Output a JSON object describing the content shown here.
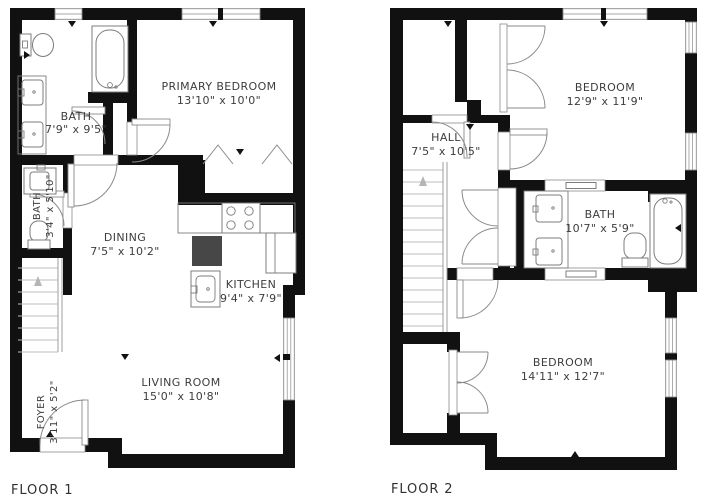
{
  "colors": {
    "wall": "#111111",
    "line": "#8a8a8a",
    "fixture": "#7c7c7c",
    "text": "#3d3d3d",
    "island": "#474747",
    "tread": "#bcbcbc",
    "arrow": "#b5b5b5"
  },
  "floors": [
    {
      "title": "FLOOR 1",
      "rooms": {
        "bath_main": {
          "name": "BATH",
          "dims": "7'9\" x 9'5\""
        },
        "primary_bedroom": {
          "name": "PRIMARY BEDROOM",
          "dims": "13'10\" x 10'0\""
        },
        "bath_small": {
          "name": "BATH",
          "dims": "3'4\" x 5'10\""
        },
        "dining": {
          "name": "DINING",
          "dims": "7'5\" x 10'2\""
        },
        "kitchen": {
          "name": "KITCHEN",
          "dims": "9'4\" x 7'9\""
        },
        "living": {
          "name": "LIVING ROOM",
          "dims": "15'0\" x 10'8\""
        },
        "foyer": {
          "name": "FOYER",
          "dims": "3'11\" x 5'2\""
        }
      }
    },
    {
      "title": "FLOOR 2",
      "rooms": {
        "hall": {
          "name": "HALL",
          "dims": "7'5\" x 10'5\""
        },
        "bedroom_top": {
          "name": "BEDROOM",
          "dims": "12'9\" x 11'9\""
        },
        "bath": {
          "name": "BATH",
          "dims": "10'7\" x 5'9\""
        },
        "bedroom_bottom": {
          "name": "BEDROOM",
          "dims": "14'11\" x 12'7\""
        }
      }
    }
  ]
}
